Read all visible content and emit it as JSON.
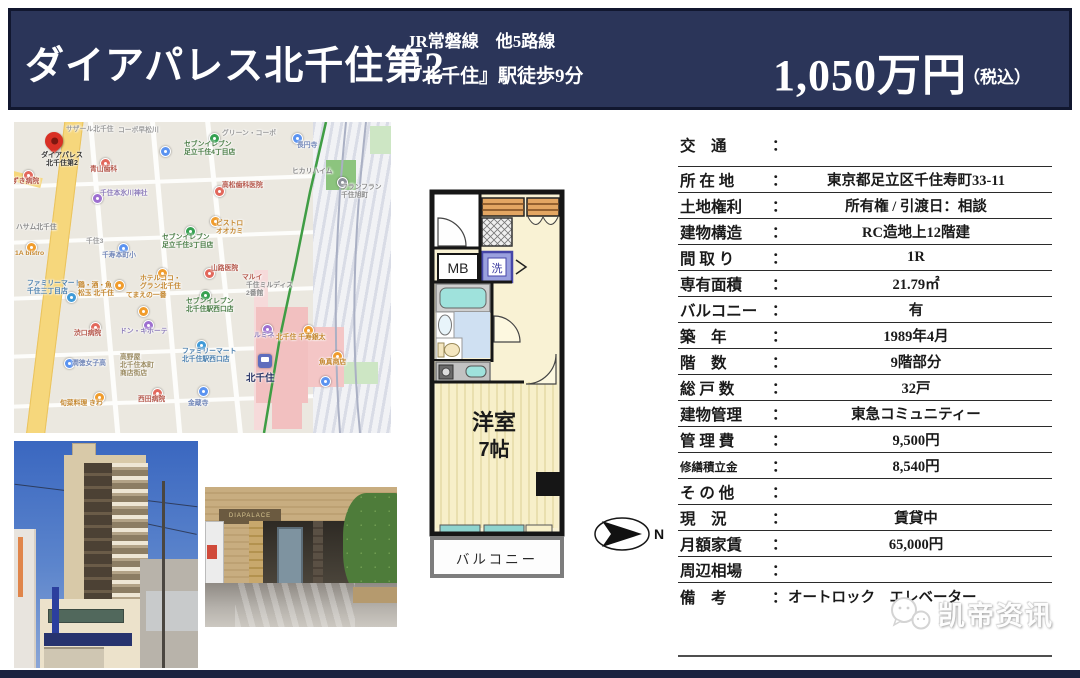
{
  "header": {
    "title": "ダイアパレス北千住第2",
    "line1": "JR常磐線　他5路線",
    "line2": "『北千住』駅徒歩9分",
    "price": "1,050万円",
    "tax_note": "（税込）"
  },
  "map": {
    "property_pin_label": "ダイアパレス\n北千住第2",
    "station_label": "北千住",
    "pins": [
      {
        "x": 9,
        "y": 48,
        "dot": "#e2685c",
        "label": "ずき病院",
        "color": "#b5574b",
        "lx": -2,
        "ly": 56
      },
      {
        "x": 86,
        "y": 36,
        "dot": "#e2685c",
        "label": "青山歯科",
        "color": "#b5574b",
        "lx": 76,
        "ly": 44
      },
      {
        "x": 146,
        "y": 24,
        "dot": "#5b93f0",
        "label": "",
        "color": "#7186b8",
        "lx": 0,
        "ly": 0
      },
      {
        "x": 195,
        "y": 11,
        "dot": "#35a151",
        "label": "セブンイレブン\n足立千住4丁目店",
        "color": "#4a7d46",
        "lx": 170,
        "ly": 19
      },
      {
        "x": 278,
        "y": 11,
        "dot": "#5b93f0",
        "label": "長円寺",
        "color": "#7186b8",
        "lx": 283,
        "ly": 20
      },
      {
        "x": 200,
        "y": 64,
        "dot": "#e2685c",
        "label": "高松歯科医院",
        "color": "#b5574b",
        "lx": 208,
        "ly": 60
      },
      {
        "x": 0,
        "y": 0,
        "dot": "",
        "label": "ヒカリハイム",
        "color": "#8a8a8a",
        "lx": 278,
        "ly": 46
      },
      {
        "x": 78,
        "y": 71,
        "dot": "#9d6fd0",
        "label": "千住本氷川神社",
        "color": "#8d7cba",
        "lx": 86,
        "ly": 68
      },
      {
        "x": 196,
        "y": 94,
        "dot": "#f09c2c",
        "label": "ビストロ\nオオカミ",
        "color": "#c4872f",
        "lx": 202,
        "ly": 98
      },
      {
        "x": 171,
        "y": 104,
        "dot": "#35a151",
        "label": "セブンイレブン\n足立千住3丁目店",
        "color": "#4a7d46",
        "lx": 148,
        "ly": 112
      },
      {
        "x": 323,
        "y": 55,
        "dot": "#8a8f98",
        "label": "フランフラン\n千住旭町",
        "color": "#8a8a8a",
        "lx": 327,
        "ly": 62
      },
      {
        "x": 0,
        "y": 0,
        "dot": "",
        "label": "ハサム北千住",
        "color": "#8a8a8a",
        "lx": 2,
        "ly": 102
      },
      {
        "x": 12,
        "y": 120,
        "dot": "#f09c2c",
        "label": "1A bistro",
        "color": "#c4872f",
        "lx": 1,
        "ly": 128
      },
      {
        "x": 104,
        "y": 121,
        "dot": "#5b93f0",
        "label": "千寿本町小",
        "color": "#7186b8",
        "lx": 88,
        "ly": 130
      },
      {
        "x": 0,
        "y": 0,
        "dot": "",
        "label": "千住3",
        "color": "#9a9a9a",
        "lx": 72,
        "ly": 116
      },
      {
        "x": 143,
        "y": 146,
        "dot": "#f09c2c",
        "label": "ホテルココ・\nグラン北千住",
        "color": "#c4872f",
        "lx": 126,
        "ly": 153
      },
      {
        "x": 190,
        "y": 146,
        "dot": "#e2685c",
        "label": "山路医院",
        "color": "#b5574b",
        "lx": 197,
        "ly": 143
      },
      {
        "x": 0,
        "y": 0,
        "dot": "",
        "label": "千住ミルディス\n2番館",
        "color": "#8a8a8a",
        "lx": 232,
        "ly": 160
      },
      {
        "x": 52,
        "y": 170,
        "dot": "#3f9ad8",
        "label": "ファミリーマート\n千住三丁目店",
        "color": "#4a7fae",
        "lx": 13,
        "ly": 158
      },
      {
        "x": 100,
        "y": 158,
        "dot": "#f09c2c",
        "label": "鶏・酒・魚\n松玉 北千住",
        "color": "#c4872f",
        "lx": 64,
        "ly": 160
      },
      {
        "x": 124,
        "y": 184,
        "dot": "#f09c2c",
        "label": "てまえの一番",
        "color": "#c4872f",
        "lx": 112,
        "ly": 170
      },
      {
        "x": 76,
        "y": 200,
        "dot": "#e2685c",
        "label": "渋口病院",
        "color": "#b5574b",
        "lx": 60,
        "ly": 208
      },
      {
        "x": 129,
        "y": 198,
        "dot": "#9d6fd0",
        "label": "ドン・キホーテ",
        "color": "#8d7cba",
        "lx": 106,
        "ly": 206
      },
      {
        "x": 186,
        "y": 168,
        "dot": "#35a151",
        "label": "セブンイレブン\n北千住駅西口店",
        "color": "#4a7d46",
        "lx": 172,
        "ly": 176
      },
      {
        "x": 182,
        "y": 218,
        "dot": "#3f9ad8",
        "label": "ファミリーマート\n北千住駅西口店",
        "color": "#4a7fae",
        "lx": 168,
        "ly": 226
      },
      {
        "x": 0,
        "y": 0,
        "dot": "",
        "label": "高野屋\n北千住本町\n商店街店",
        "color": "#9a8a60",
        "lx": 106,
        "ly": 232
      },
      {
        "x": 50,
        "y": 236,
        "dot": "#5b93f0",
        "label": "潤徳女子高",
        "color": "#7186b8",
        "lx": 58,
        "ly": 238
      },
      {
        "x": 80,
        "y": 270,
        "dot": "#f09c2c",
        "label": "旬菜料理 きわ",
        "color": "#c4872f",
        "lx": 46,
        "ly": 278
      },
      {
        "x": 138,
        "y": 266,
        "dot": "#e2685c",
        "label": "西田病院",
        "color": "#b5574b",
        "lx": 124,
        "ly": 274
      },
      {
        "x": 184,
        "y": 264,
        "dot": "#5b93f0",
        "label": "金蔵寺",
        "color": "#7186b8",
        "lx": 174,
        "ly": 278
      },
      {
        "x": 248,
        "y": 202,
        "dot": "#9d6fd0",
        "label": "ルミネ",
        "color": "#8d7cba",
        "lx": 240,
        "ly": 210
      },
      {
        "x": 289,
        "y": 203,
        "dot": "#f09c2c",
        "label": "北千住 千寿銀太",
        "color": "#c4872f",
        "lx": 262,
        "ly": 212
      },
      {
        "x": 318,
        "y": 229,
        "dot": "#f09c2c",
        "label": "魚真商店",
        "color": "#c4872f",
        "lx": 305,
        "ly": 237
      },
      {
        "x": 306,
        "y": 254,
        "dot": "#5b93f0",
        "label": "",
        "color": "#7186b8",
        "lx": 0,
        "ly": 0
      },
      {
        "x": 0,
        "y": 0,
        "dot": "",
        "label": "マルイ",
        "color": "#b5574b",
        "lx": 228,
        "ly": 152
      },
      {
        "x": 0,
        "y": 0,
        "dot": "",
        "label": "サザール北千住",
        "color": "#999999",
        "lx": 52,
        "ly": 4
      },
      {
        "x": 0,
        "y": 0,
        "dot": "",
        "label": "コーポ早松川",
        "color": "#999999",
        "lx": 104,
        "ly": 5
      },
      {
        "x": 0,
        "y": 0,
        "dot": "",
        "label": "グリーン・コーポ",
        "color": "#999999",
        "lx": 208,
        "ly": 8
      }
    ]
  },
  "floorplan": {
    "mb_label": "MB",
    "washer_label": "洗",
    "room_label": "洋室",
    "room_size": "7帖",
    "balcony_label": "バルコニー",
    "compass_n": "N"
  },
  "table": {
    "colon": "：",
    "rows": [
      {
        "label": "交　通",
        "value": ""
      },
      {
        "label": "所 在 地",
        "value": "東京都足立区千住寿町33-11"
      },
      {
        "label": "土地権利",
        "value": "所有権 / 引渡日：相談"
      },
      {
        "label": "建物構造",
        "value": "RC造地上12階建"
      },
      {
        "label": "間 取 り",
        "value": "1R"
      },
      {
        "label": "専有面積",
        "value": "21.79㎡"
      },
      {
        "label": "バルコニー",
        "value": "有"
      },
      {
        "label": "築　年",
        "value": "1989年4月"
      },
      {
        "label": "階　数",
        "value": "9階部分"
      },
      {
        "label": "総 戸 数",
        "value": "32戸"
      },
      {
        "label": "建物管理",
        "value": "東急コミュニティー"
      },
      {
        "label": "管 理 費",
        "value": "9,500円"
      },
      {
        "label": "修繕積立金",
        "value": "8,540円"
      },
      {
        "label": "そ の 他",
        "value": ""
      },
      {
        "label": "現　況",
        "value": "賃貸中"
      },
      {
        "label": "月額家賃",
        "value": "65,000円"
      },
      {
        "label": "周辺相場",
        "value": ""
      },
      {
        "label": "備　考",
        "value": "オートロック　エレベーター"
      }
    ]
  },
  "watermark": {
    "text": "凯帝资讯"
  },
  "colors": {
    "header_navy": "#2b3559",
    "map_yellow_road": "#f6d77c",
    "map_rail_green": "#3f9d44",
    "map_station_pink": "#f2c0c0",
    "plan_cream": "#f9f2d4",
    "plan_cyan": "#9fe2dc",
    "plan_orange": "#e3a662",
    "marker_red": "#d93025"
  }
}
